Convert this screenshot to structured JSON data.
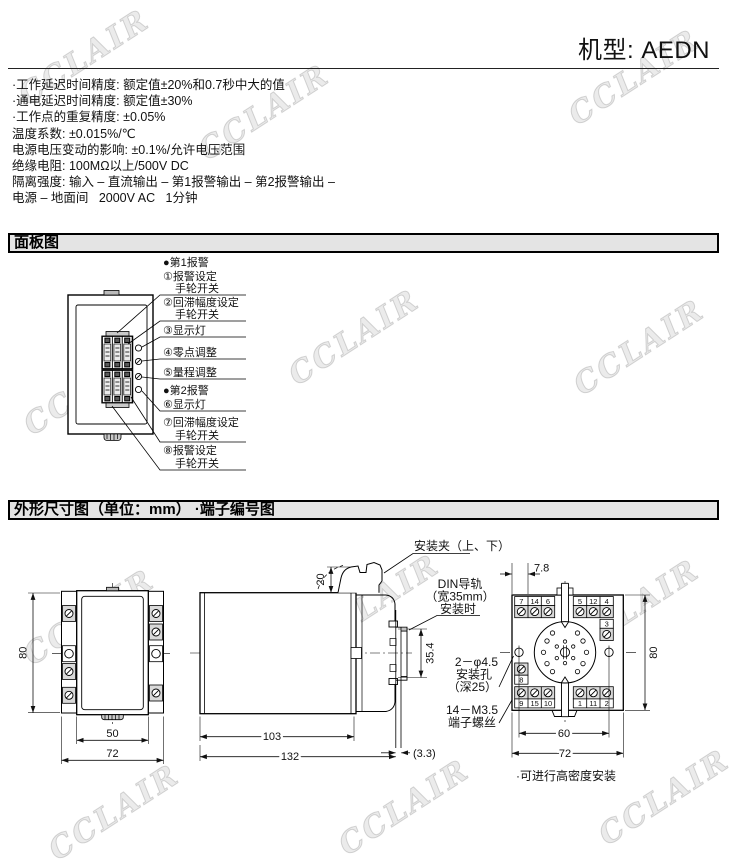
{
  "page": {
    "model_label": "机型: AEDN"
  },
  "watermark": {
    "text": "CCLAIR"
  },
  "specs": {
    "lines": [
      "·工作延迟时间精度: 额定值±20%和0.7秒中大的值",
      "·通电延迟时间精度: 额定值±30%",
      "·工作点的重复精度: ±0.05%",
      "温度系数: ±0.015%/℃",
      "电源电压变动的影响: ±0.1%/允许电压范围",
      "绝缘电阻: 100MΩ以上/500V DC",
      "隔离强度: 输入 – 直流输出 – 第1报警输出 – 第2报警输出 –",
      "电源 – 地面间   2000V AC   1分钟"
    ]
  },
  "sections": {
    "panel_title": "面板图",
    "outline_title": "外形尺寸图（单位：mm） ·端子编号图"
  },
  "panel": {
    "alarm1_header": "●第1报警",
    "l1a": "①报警设定",
    "l1b": "手轮开关",
    "l2a": "②回滞幅度设定",
    "l2b": "手轮开关",
    "l3": "③显示灯",
    "l4": "④零点调整",
    "l5": "⑤量程调整",
    "alarm2_header": "●第2报警",
    "l6": "⑥显示灯",
    "l7a": "⑦回滞幅度设定",
    "l7b": "手轮开关",
    "l8a": "⑧报警设定",
    "l8b": "手轮开关"
  },
  "outline": {
    "front": {
      "height": "80",
      "width_inner": "50",
      "width_outer": "72"
    },
    "side": {
      "clip_offset": "20",
      "rail_height": "35.4",
      "depth_body": "103",
      "depth_total": "132",
      "rail_extra": "(3.3)"
    },
    "rear": {
      "pitch": "7.8",
      "height": "80",
      "hole_span": "60",
      "width": "72",
      "terminals": {
        "top_left": [
          "7",
          "14",
          "6"
        ],
        "top_right": [
          "5",
          "12",
          "4"
        ],
        "right": [
          "3"
        ],
        "left": [
          "8"
        ],
        "bottom_left": [
          "9",
          "15",
          "10"
        ],
        "bottom_right": [
          "1",
          "11",
          "2"
        ]
      }
    },
    "callouts": {
      "clip": "安装夹（上、下）",
      "din1": "DIN导轨",
      "din2": "（宽35mm）",
      "din3": "安装时",
      "hole1": "2－φ4.5",
      "hole2": "安装孔",
      "hole3": "（深25）",
      "screw1": "14－M3.5",
      "screw2": "端子螺丝",
      "note": "·可进行高密度安装"
    }
  }
}
